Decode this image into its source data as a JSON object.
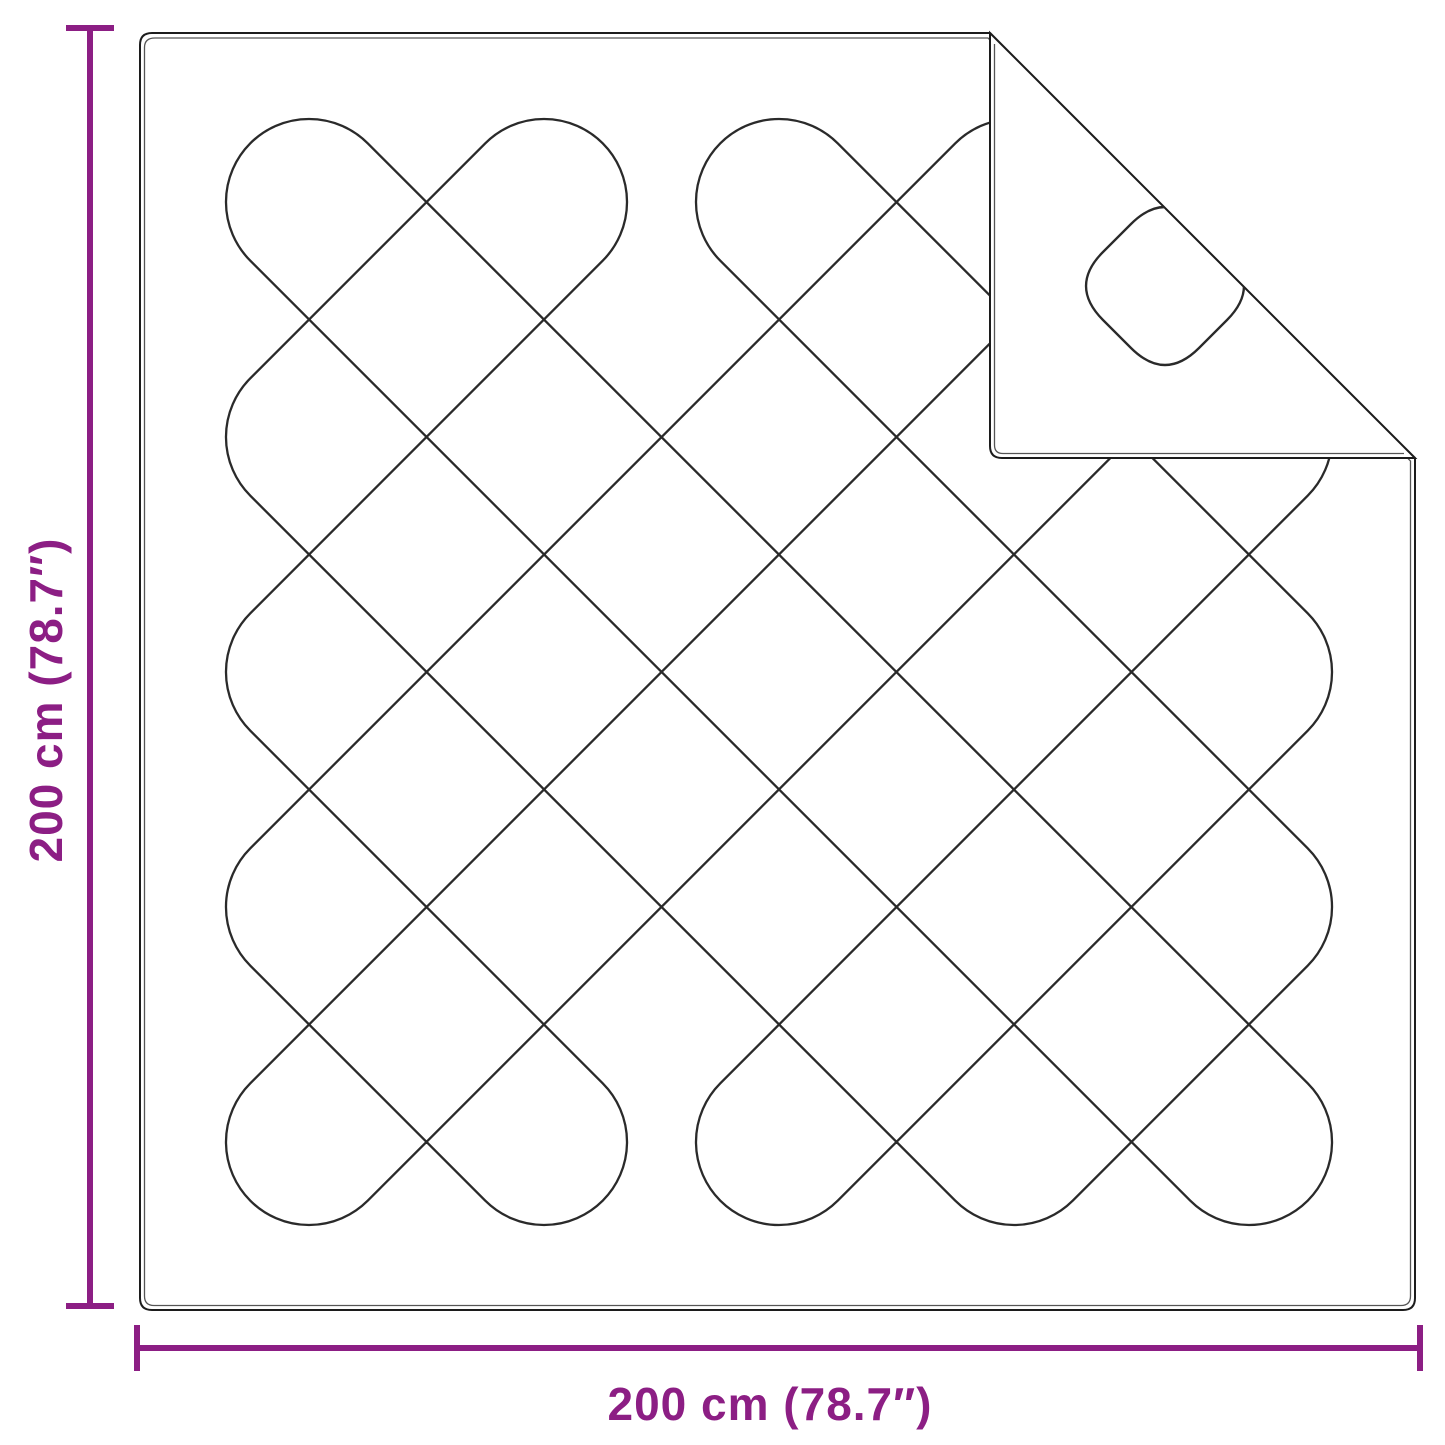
{
  "diagram": {
    "type": "product-dimension-diagram",
    "subject": "quilted blanket with folded corner",
    "dimensions": {
      "height_label": "200 cm (78.7″)",
      "width_label": "200 cm (78.7″)"
    },
    "colors": {
      "accent": "#8c1e84",
      "line_dark": "#2a2a2a",
      "border_inner": "#555555",
      "background": "#ffffff"
    },
    "icons": {
      "vertical_dimension_arrow": "dimension-extent-vertical",
      "horizontal_dimension_arrow": "dimension-extent-horizontal"
    }
  }
}
